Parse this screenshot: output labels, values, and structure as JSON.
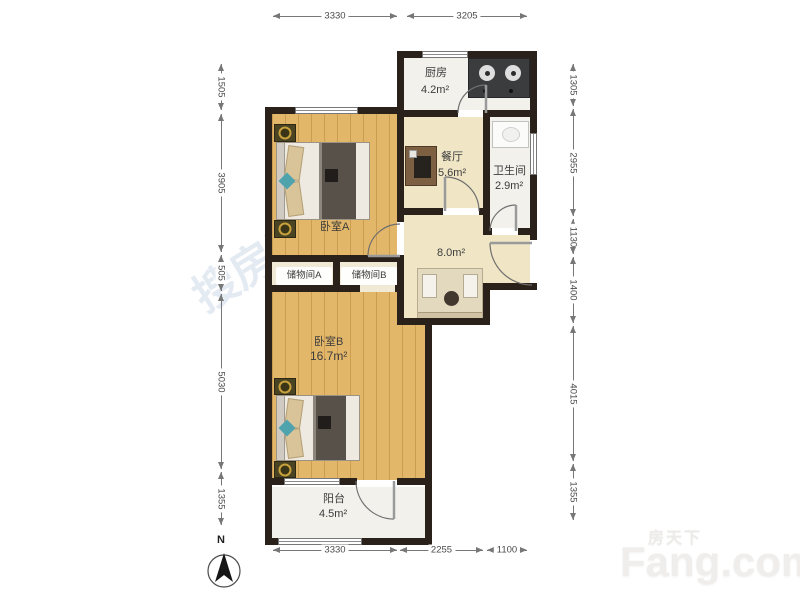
{
  "compass": {
    "label": "N"
  },
  "watermarks": {
    "center": "搜房网",
    "brand_cn": "房天下",
    "brand_en": "Fang.com"
  },
  "rooms": {
    "kitchen": {
      "name": "厨房",
      "area": "4.2m²"
    },
    "dining": {
      "name": "餐厅",
      "area": "5.6m²"
    },
    "bathroom": {
      "name": "卫生间",
      "area": "2.9m²"
    },
    "bedroom_a": {
      "name": "卧室A"
    },
    "storage_a": {
      "name": "储物间A"
    },
    "storage_b": {
      "name": "储物间B"
    },
    "hall": {
      "area": "8.0m²"
    },
    "bedroom_b": {
      "name": "卧室B",
      "area": "16.7m²"
    },
    "balcony": {
      "name": "阳台",
      "area": "4.5m²"
    }
  },
  "dimensions": {
    "top": [
      "3330",
      "3205"
    ],
    "bottom": [
      "3330",
      "2255",
      "1100"
    ],
    "left": [
      "1505",
      "3905",
      "505",
      "5030",
      "1355"
    ],
    "right": [
      "1305",
      "2955",
      "1130",
      "1400",
      "4015",
      "1355"
    ]
  },
  "colors": {
    "wall": "#2a211a",
    "wood_floor": "#e3b76a",
    "tile_floor": "#f2f1ec",
    "beige_floor": "#f0e6c6",
    "accent_teal": "#4fa3ad"
  }
}
